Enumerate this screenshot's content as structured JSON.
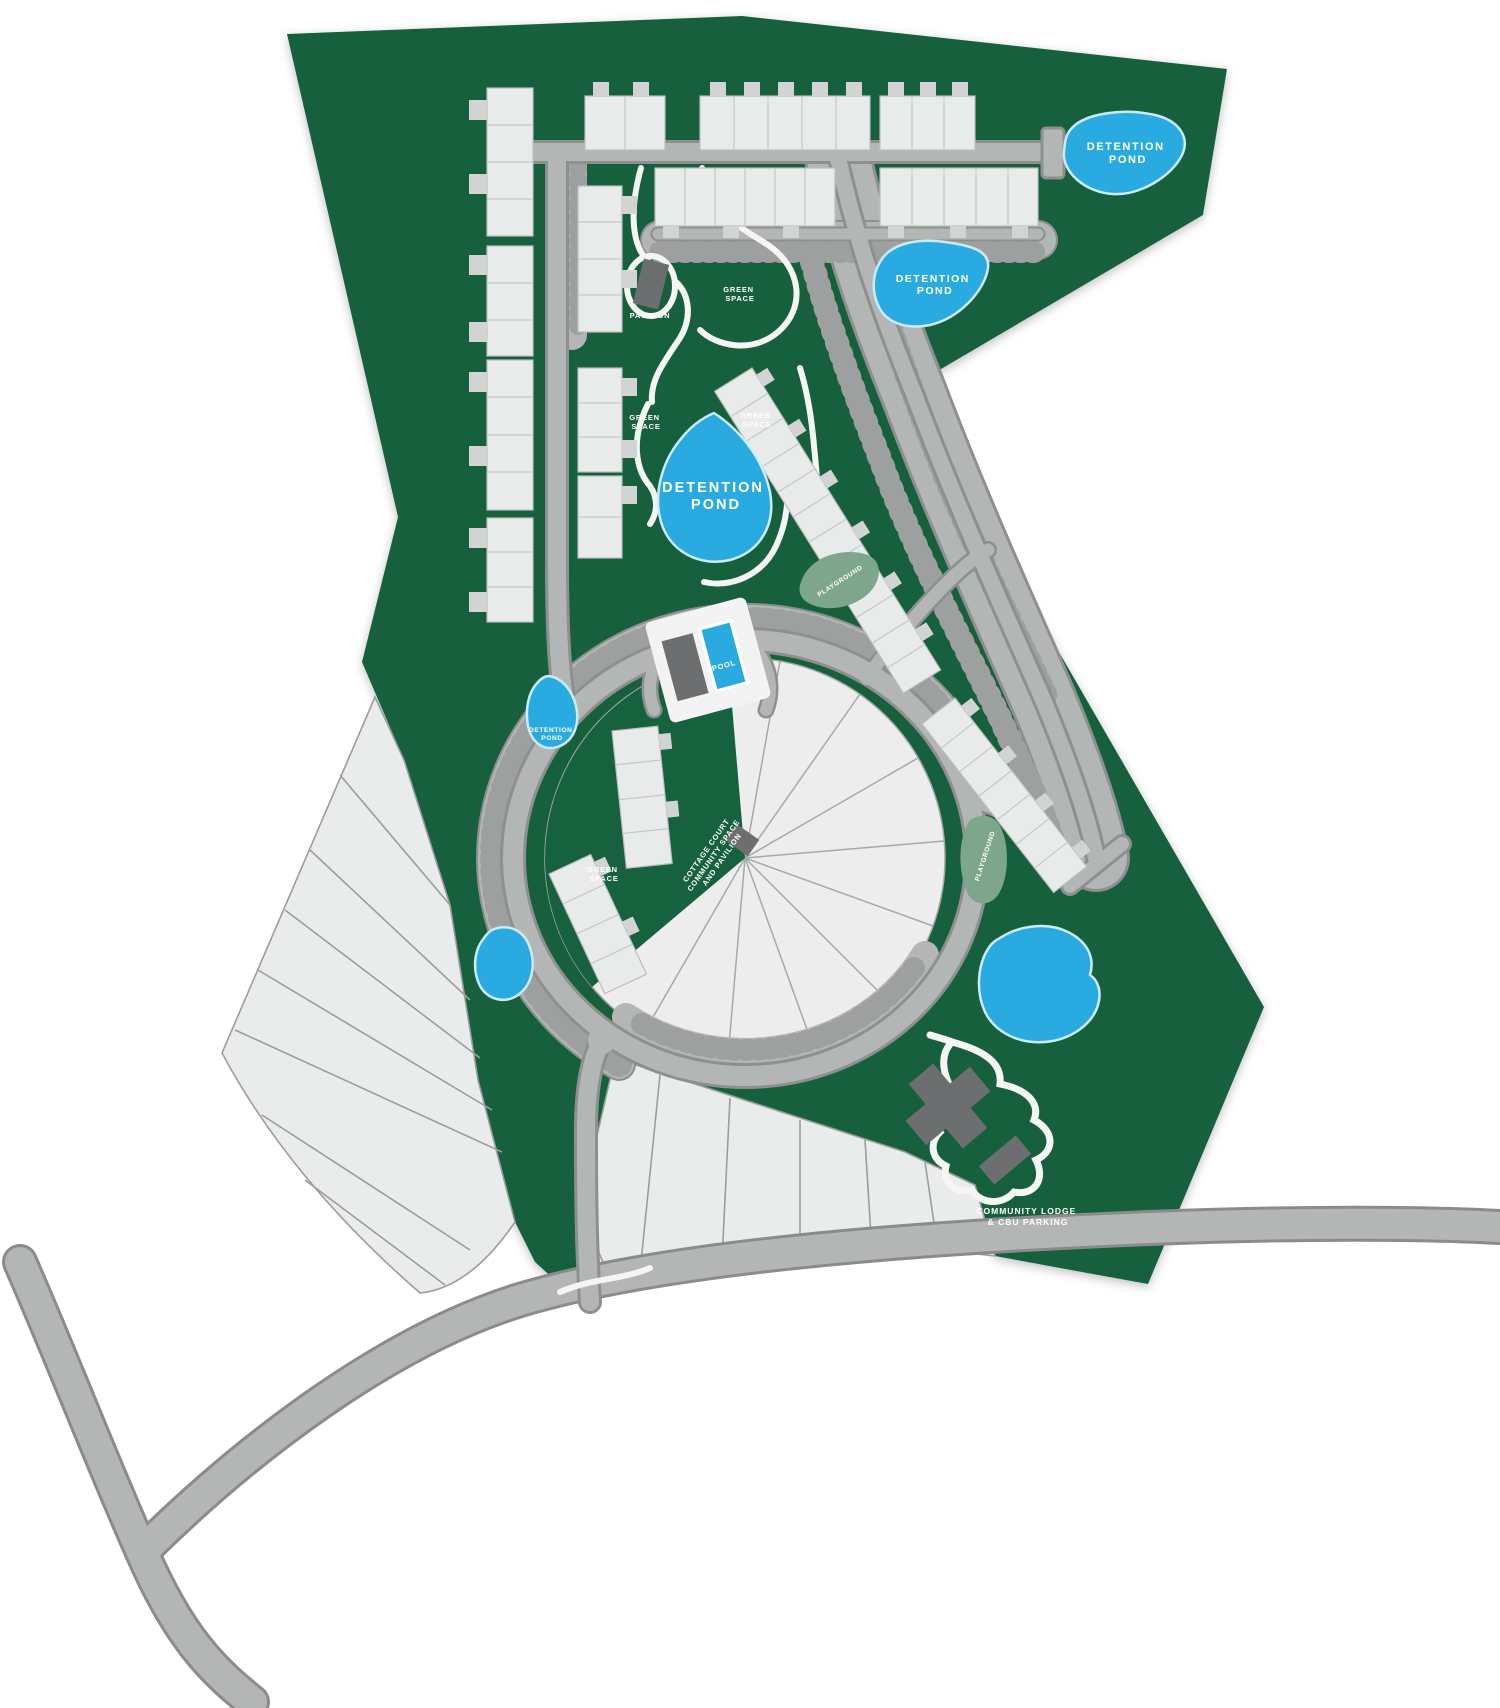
{
  "map_colors": {
    "site_green": "#16613E",
    "road_fill": "#b4b6b5",
    "road_casing": "#8a8c8b",
    "parking_tick": "#9da09f",
    "lot_fill": "#eaecec",
    "lot_line": "#9b9d9c",
    "building_fill": "#e9eaea",
    "building_dark": "#6c6e70",
    "pond_blue": "#29abe2",
    "pond_border": "#cdeaf8",
    "path_white": "#f5f6f4",
    "playground_sage": "#7ea68c",
    "label_text": "#ffffff"
  },
  "labels": {
    "pond_top_right": {
      "l1": "DETENTION",
      "l2": "POND"
    },
    "pond_north": {
      "l1": "DETENTION",
      "l2": "POND"
    },
    "pond_central": {
      "l1": "DETENTION",
      "l2": "POND"
    },
    "pond_west": {
      "l1": "DETENTION",
      "l2": "POND"
    },
    "green_space_1": {
      "l1": "GREEN",
      "l2": "SPACE"
    },
    "green_space_2": {
      "l1": "GREEN",
      "l2": "SPACE"
    },
    "green_space_3": {
      "l1": "GREEN",
      "l2": "SPACE"
    },
    "green_space_4": {
      "l1": "GREEN",
      "l2": "SPACE"
    },
    "pavilion": "PAVILION",
    "pool": "POOL",
    "playground_north": "PLAYGROUND",
    "playground_south": "PLAYGROUND",
    "cottage_court": {
      "l1": "COTTAGE COURT",
      "l2": "COMMUNITY SPACE",
      "l3": "AND PAVILION"
    },
    "community_lodge": {
      "l1": "COMMUNITY LODGE",
      "l2": "& CBU PARKING"
    }
  }
}
